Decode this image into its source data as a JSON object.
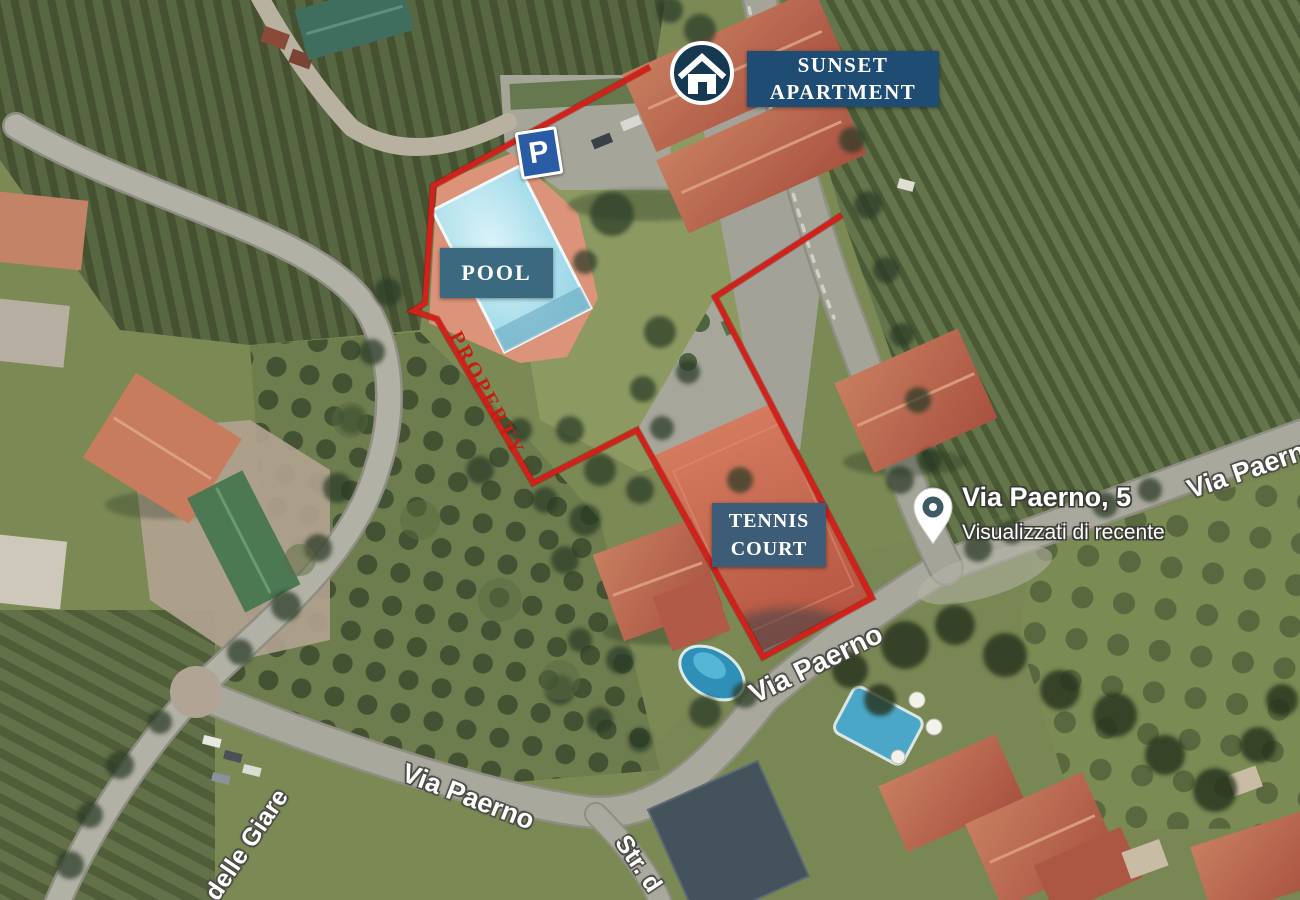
{
  "annotations": {
    "apartment": {
      "line1": "SUNSET",
      "line2": "APARTMENT"
    },
    "pool": "POOL",
    "tennis": {
      "line1": "TENNIS",
      "line2": "COURT"
    },
    "property": "PROPERTY",
    "parking": "P"
  },
  "map_pin": {
    "title": "Via Paerno, 5",
    "subtitle": "Visualizzati di recente"
  },
  "streets": {
    "via_paerno_sw": "Via Paerno",
    "via_paerno_mid": "Via Paerno",
    "via_paerno_e": "Via Paerno",
    "delle_giare": "delle Giare",
    "str_d": "Str. d"
  },
  "colors": {
    "boundary": "#d2201a",
    "apartment_badge": "#1e4c72",
    "pool_badge": "#3b6a80",
    "tennis_badge": "#3c5c77",
    "parking_sign": "#2a5ca6",
    "property_text": "#c41f12"
  }
}
